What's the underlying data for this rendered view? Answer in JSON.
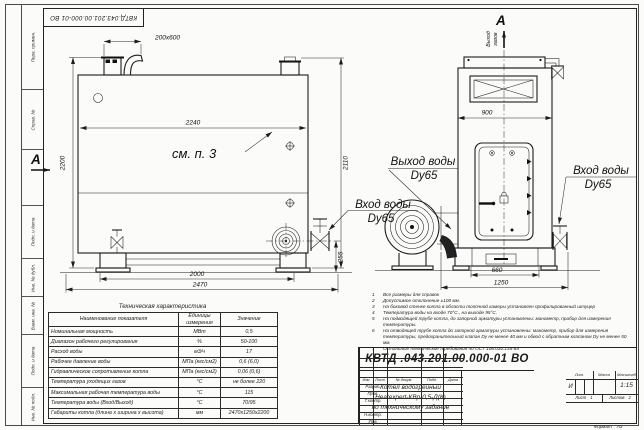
{
  "stamp": {
    "doc_number_top": "КВТД.043.201.00.000-01 ВО"
  },
  "frame": {
    "left_fields": [
      "Перв. примен.",
      "Справ. №",
      "Подп. и дата",
      "Инв. № дубл.",
      "Взам. инв. №",
      "Подп. и дата",
      "Инв. № подл."
    ],
    "format_label": "Формат",
    "format_value": "А3"
  },
  "drawing": {
    "side_view": {
      "section_label": "A",
      "see_note": "см. п. 3",
      "dim_flue": "200x600",
      "dim_width_inner": "2240",
      "dim_height_right": "2110",
      "dim_height_left": "2200",
      "dim_base_inner": "2000",
      "dim_base_outer": "2470",
      "dim_inlet_height": "255",
      "outlet_label": "Выход воды",
      "outlet_dn": "Dy65",
      "inlet_label": "Вход воды",
      "inlet_dn": "Dy65"
    },
    "front_view": {
      "section_label": "A",
      "gas_outlet_line1": "Выход",
      "gas_outlet_line2": "газов",
      "dim_width": "900",
      "dim_base_inner": "660",
      "dim_base_outer": "1250",
      "inlet_label": "Вход воды",
      "inlet_dn": "Dy65"
    }
  },
  "tech_table": {
    "title": "Техническая характеристика",
    "headers": [
      "Наименование показателя",
      "Единицы измерения",
      "Значение"
    ],
    "rows": [
      [
        "Номинальная мощность",
        "МВт",
        "0,5"
      ],
      [
        "Диапазон рабочего регулирования",
        "%",
        "50-100"
      ],
      [
        "Расход воды",
        "м3/ч",
        "17"
      ],
      [
        "Рабочее давление воды",
        "МПа (кгс/см2)",
        "0,6 (6,0)"
      ],
      [
        "Гидравлическое сопротивление котла",
        "МПа (кгс/см2)",
        "0,06 (0,6)"
      ],
      [
        "Температура уходящих газов",
        "°С",
        "не более 220"
      ],
      [
        "Максимальная рабочая температура воды",
        "°С",
        "115"
      ],
      [
        "Температура воды (Вход/Выход)",
        "°С",
        "70/95"
      ],
      [
        "Габариты котла (длина х ширина х высота)",
        "мм",
        "2470х1250х2200"
      ]
    ]
  },
  "notes": [
    {
      "n": "1",
      "t": "Все размеры для справок"
    },
    {
      "n": "2",
      "t": "Допустимое отклонение ±100 мм."
    },
    {
      "n": "3",
      "t": "На боковой стенке котла в области топочной камеры установлен профилированный штуцер"
    },
    {
      "n": "4",
      "t": "Температура воды на входе 70°С., на выходе 95°С."
    },
    {
      "n": "5",
      "t": "На подводящей трубе котла, до запорной арматуры установлены: манометр, прибор для измерения температуры."
    },
    {
      "n": "6",
      "t": "На отводящей трубе котла до запорной арматуры установлены: манометр, прибор для измерения температуры, предохранительный клапан Dу не менее 40 мм и обвод с обратным клапаном Dу не менее 50 мм."
    },
    {
      "n": "7",
      "t": "Остальные технические требования по ОСТ 108.030.135-84"
    }
  ],
  "title_block": {
    "doc_number": "КВТД .043.201.00.000-01  ВО",
    "product_line1": "Котел водогрейный",
    "product_line2": "Heatexpert-КВр-0,5-Д(К)",
    "product_line3": "по техническому задание",
    "cols": [
      "Изм",
      "Лист",
      "№ докум.",
      "Подп.",
      "Дата"
    ],
    "rows": [
      "Разраб.",
      "Пров.",
      "Т.контр.",
      "Н.контр.",
      "Утв."
    ],
    "lit_label": "Лит.",
    "lit_value": "И",
    "mass_label": "Масса",
    "scale_label": "Масштаб",
    "scale_value": "1:15",
    "sheet_label": "Лист",
    "sheet_value": "1",
    "sheets_label": "Листов",
    "sheets_value": "2",
    "logo": "KVZR",
    "logo_sub1": "КОТЕЛЬНЫЙ",
    "logo_sub2": "ЗАВОД РЭП"
  }
}
